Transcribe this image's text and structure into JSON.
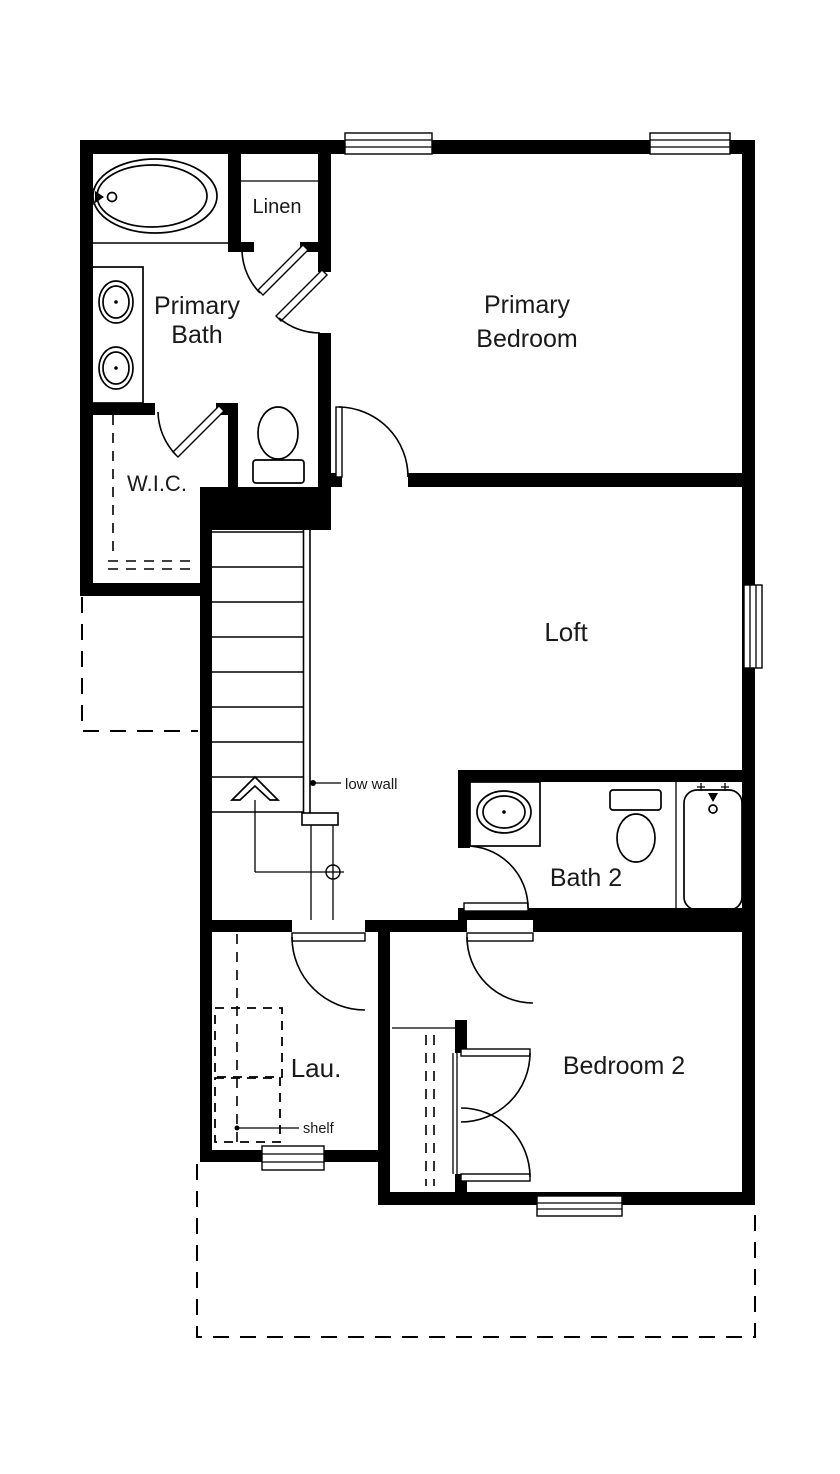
{
  "colors": {
    "background": "#ffffff",
    "walls": "#000000",
    "text": "#1a1a1a"
  },
  "rooms": [
    {
      "name": "Primary Bath",
      "line1": "Primary",
      "line2": "Bath"
    },
    {
      "name": "Linen",
      "line1": "Linen"
    },
    {
      "name": "Primary Bedroom",
      "line1": "Primary",
      "line2": "Bedroom"
    },
    {
      "name": "W.I.C.",
      "line1": "W.I.C."
    },
    {
      "name": "Loft",
      "line1": "Loft"
    },
    {
      "name": "Bath 2",
      "line1": "Bath 2"
    },
    {
      "name": "Laundry",
      "line1": "Lau."
    },
    {
      "name": "Bedroom 2",
      "line1": "Bedroom 2"
    }
  ],
  "annotations": {
    "low_wall": "low wall",
    "shelf": "shelf"
  }
}
